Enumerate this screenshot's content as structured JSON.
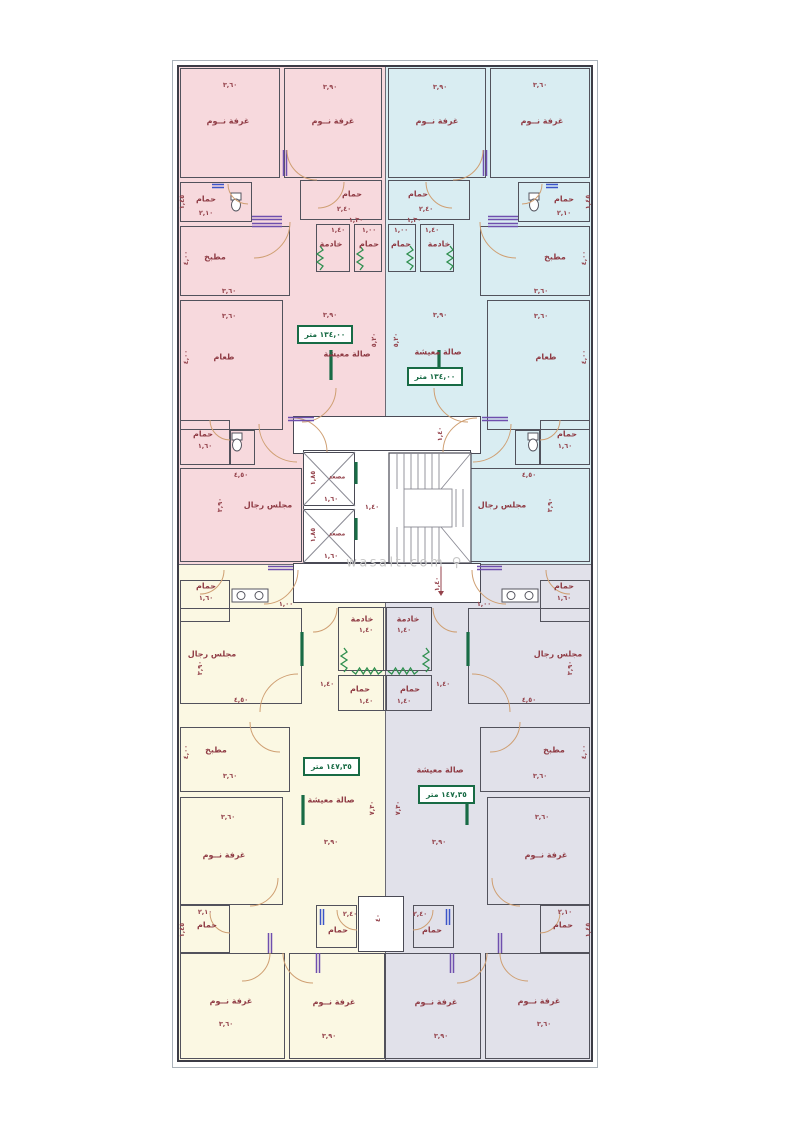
{
  "watermark": {
    "text": "wasalt.com",
    "icon": "⚲"
  },
  "colors": {
    "unit_top_left": "#f7d9dd",
    "unit_top_right": "#d9edf2",
    "unit_bottom_left": "#fbf8e3",
    "unit_bottom_right": "#e1e1ea",
    "wall": "#3c3c46",
    "room_line": "#52525c",
    "label": "#8f3b44",
    "area_green": "#186b45",
    "window_green": "#2f8f4f",
    "door_arc": "#cf9f72",
    "door_leaf_purple": "#6f4fae",
    "door_leaf_blue": "#3b55c9"
  },
  "plan": {
    "axis": 385,
    "frame": {
      "x": 172,
      "y": 60,
      "w": 426,
      "h": 1008
    },
    "outer": {
      "x": 177,
      "y": 65,
      "w": 416,
      "h": 997
    },
    "units": [
      {
        "id": "apartment-top-left",
        "fill": "#f7d9dd",
        "x": 177,
        "y": 65,
        "w": 208,
        "h": 499,
        "area_label": "١٣٤,٠٠ متر"
      },
      {
        "id": "apartment-top-right",
        "fill": "#d9edf2",
        "x": 385,
        "y": 65,
        "w": 208,
        "h": 499,
        "area_label": "١٣٤,٠٠ متر"
      },
      {
        "id": "apartment-bottom-left",
        "fill": "#fbf8e3",
        "x": 177,
        "y": 564,
        "w": 208,
        "h": 498,
        "area_label": "١٤٧,٣٥ متر"
      },
      {
        "id": "apartment-bottom-right",
        "fill": "#e1e1ea",
        "x": 385,
        "y": 564,
        "w": 208,
        "h": 498,
        "area_label": "١٤٧,٣٥ متر"
      }
    ],
    "dividers": [
      {
        "x": 385,
        "y": 65,
        "w": 1,
        "h": 997
      },
      {
        "x": 177,
        "y": 564,
        "w": 416,
        "h": 1
      }
    ],
    "core_white": [
      {
        "x": 293,
        "y": 416,
        "w": 188,
        "h": 38
      },
      {
        "x": 303,
        "y": 450,
        "w": 168,
        "h": 113
      },
      {
        "x": 293,
        "y": 563,
        "w": 188,
        "h": 40
      },
      {
        "x": 358,
        "y": 896,
        "w": 46,
        "h": 56
      },
      {
        "x": 303,
        "y": 452,
        "w": 52,
        "h": 54
      },
      {
        "x": 303,
        "y": 509,
        "w": 52,
        "h": 54
      }
    ],
    "stairs": {
      "x": 389,
      "y": 453,
      "w": 82,
      "h": 110,
      "band": 36,
      "inset": 15
    },
    "top_half": [
      {
        "t": "room",
        "n": "bedroom",
        "x": 180,
        "y": 68,
        "w": 100,
        "h": 110
      },
      {
        "t": "room",
        "n": "bedroom",
        "x": 284,
        "y": 68,
        "w": 98,
        "h": 110
      },
      {
        "t": "room",
        "n": "bathroom",
        "x": 180,
        "y": 182,
        "w": 72,
        "h": 40
      },
      {
        "t": "room",
        "n": "bathroom",
        "x": 300,
        "y": 180,
        "w": 82,
        "h": 40
      },
      {
        "t": "room",
        "n": "maid-room",
        "x": 316,
        "y": 224,
        "w": 34,
        "h": 48
      },
      {
        "t": "room",
        "n": "bathroom",
        "x": 354,
        "y": 224,
        "w": 28,
        "h": 48
      },
      {
        "t": "room",
        "n": "kitchen",
        "x": 180,
        "y": 226,
        "w": 110,
        "h": 70
      },
      {
        "t": "room",
        "n": "dining-room",
        "x": 180,
        "y": 300,
        "w": 103,
        "h": 130
      },
      {
        "t": "room",
        "n": "bathroom",
        "x": 180,
        "y": 420,
        "w": 50,
        "h": 45
      },
      {
        "t": "room",
        "n": "wc-alcove",
        "x": 230,
        "y": 430,
        "w": 25,
        "h": 35
      },
      {
        "t": "room",
        "n": "majlis",
        "x": 180,
        "y": 468,
        "w": 122,
        "h": 94
      },
      {
        "t": "dim",
        "x": 230,
        "y": 85,
        "s": "٣,٦٠"
      },
      {
        "t": "lbl",
        "x": 228,
        "y": 121,
        "s": "غرفة نــوم"
      },
      {
        "t": "dim",
        "x": 330,
        "y": 87,
        "s": "٣,٩٠"
      },
      {
        "t": "lbl",
        "x": 333,
        "y": 121,
        "s": "غرفة نــوم"
      },
      {
        "t": "dim",
        "x": 182,
        "y": 202,
        "s": "١,٤٥",
        "r": 1
      },
      {
        "t": "lbl",
        "x": 206,
        "y": 199,
        "s": "حمام"
      },
      {
        "t": "dim",
        "x": 206,
        "y": 213,
        "s": "٢,١٠"
      },
      {
        "t": "lbl",
        "x": 352,
        "y": 194,
        "s": "حمام"
      },
      {
        "t": "dim",
        "x": 344,
        "y": 209,
        "s": "٢,٤٠"
      },
      {
        "t": "dim",
        "x": 338,
        "y": 230,
        "s": "١,٤٠"
      },
      {
        "t": "lbl",
        "x": 331,
        "y": 244,
        "s": "خادمة"
      },
      {
        "t": "dim",
        "x": 369,
        "y": 230,
        "s": "١,٠٠"
      },
      {
        "t": "lbl",
        "x": 369,
        "y": 244,
        "s": "حمام"
      },
      {
        "t": "lbl",
        "x": 215,
        "y": 257,
        "s": "مطبخ"
      },
      {
        "t": "dim",
        "x": 186,
        "y": 258,
        "s": "٤,٠٠",
        "r": 1
      },
      {
        "t": "dim",
        "x": 229,
        "y": 291,
        "s": "٣,٦٠"
      },
      {
        "t": "dim",
        "x": 229,
        "y": 316,
        "s": "٣,٦٠"
      },
      {
        "t": "lbl",
        "x": 224,
        "y": 357,
        "s": "طعام"
      },
      {
        "t": "dim",
        "x": 186,
        "y": 357,
        "s": "٤,٠٠",
        "r": 1
      },
      {
        "t": "dim",
        "x": 356,
        "y": 220,
        "s": "١,٣٠"
      },
      {
        "t": "dim",
        "x": 330,
        "y": 315,
        "s": "٣,٩٠"
      },
      {
        "t": "dim",
        "x": 374,
        "y": 340,
        "s": "٥,٢٠",
        "r": 1
      },
      {
        "t": "lbl",
        "x": 203,
        "y": 434,
        "s": "حمام"
      },
      {
        "t": "dim",
        "x": 205,
        "y": 446,
        "s": "١,٦٠"
      },
      {
        "t": "dim",
        "x": 241,
        "y": 475,
        "s": "٤,٥٠"
      },
      {
        "t": "lbl",
        "x": 268,
        "y": 505,
        "s": "مجلس رجال"
      },
      {
        "t": "dim",
        "x": 220,
        "y": 505,
        "s": "٣,٩٠",
        "r": 1
      },
      {
        "t": "zz",
        "x": 320,
        "y": 246,
        "l": 24,
        "v": 1
      },
      {
        "t": "zz",
        "x": 360,
        "y": 246,
        "l": 24,
        "v": 1
      },
      {
        "t": "gbar",
        "x": 331,
        "y": 350,
        "l": 30,
        "v": 1
      },
      {
        "t": "wc",
        "x": 236,
        "y": 200
      },
      {
        "t": "wc",
        "x": 237,
        "y": 440
      },
      {
        "t": "door",
        "x": 285,
        "y": 150,
        "l": 26,
        "v": 1,
        "c": "p"
      },
      {
        "t": "door",
        "x": 252,
        "y": 218,
        "l": 30,
        "v": 0,
        "c": "p"
      },
      {
        "t": "door",
        "x": 252,
        "y": 225,
        "l": 30,
        "v": 0,
        "c": "p"
      },
      {
        "t": "door",
        "x": 212,
        "y": 186,
        "l": 12,
        "v": 0,
        "c": "b"
      },
      {
        "t": "arc",
        "x": 317,
        "y": 150,
        "rr": 30,
        "a": 90
      },
      {
        "t": "arc",
        "x": 248,
        "y": 184,
        "rr": 20,
        "a": 90
      },
      {
        "t": "arc",
        "x": 318,
        "y": 182,
        "rr": 26,
        "a": 0
      },
      {
        "t": "arc",
        "x": 254,
        "y": 222,
        "rr": 36,
        "a": 0
      },
      {
        "t": "arc",
        "x": 302,
        "y": 388,
        "rr": 34,
        "a": 0
      },
      {
        "t": "arc",
        "x": 297,
        "y": 424,
        "rr": 38,
        "a": 90
      },
      {
        "t": "arc",
        "x": 230,
        "y": 420,
        "rr": 20,
        "a": 90
      }
    ],
    "bottom_half": [
      {
        "t": "room",
        "n": "bathroom",
        "x": 180,
        "y": 580,
        "w": 50,
        "h": 42
      },
      {
        "t": "room",
        "n": "majlis",
        "x": 180,
        "y": 608,
        "w": 122,
        "h": 96
      },
      {
        "t": "room",
        "n": "maid-room",
        "x": 338,
        "y": 607,
        "w": 49,
        "h": 64
      },
      {
        "t": "room",
        "n": "bathroom",
        "x": 338,
        "y": 675,
        "w": 49,
        "h": 36
      },
      {
        "t": "room",
        "n": "kitchen",
        "x": 180,
        "y": 727,
        "w": 110,
        "h": 65
      },
      {
        "t": "room",
        "n": "bedroom",
        "x": 180,
        "y": 797,
        "w": 103,
        "h": 108
      },
      {
        "t": "room",
        "n": "bathroom",
        "x": 180,
        "y": 905,
        "w": 50,
        "h": 48
      },
      {
        "t": "room",
        "n": "bathroom",
        "x": 316,
        "y": 905,
        "w": 41,
        "h": 43
      },
      {
        "t": "room",
        "n": "bedroom",
        "x": 180,
        "y": 953,
        "w": 105,
        "h": 106
      },
      {
        "t": "room",
        "n": "bedroom",
        "x": 289,
        "y": 953,
        "w": 96,
        "h": 106
      },
      {
        "t": "lbl",
        "x": 206,
        "y": 586,
        "s": "حمام"
      },
      {
        "t": "dim",
        "x": 206,
        "y": 598,
        "s": "١,٦٠"
      },
      {
        "t": "dim",
        "x": 286,
        "y": 604,
        "s": "١,٠٠"
      },
      {
        "t": "lbl",
        "x": 212,
        "y": 654,
        "s": "مجلس رجال"
      },
      {
        "t": "dim",
        "x": 200,
        "y": 668,
        "s": "٣,٩٠",
        "r": 1
      },
      {
        "t": "dim",
        "x": 241,
        "y": 700,
        "s": "٤,٥٠"
      },
      {
        "t": "lbl",
        "x": 362,
        "y": 619,
        "s": "خادمة"
      },
      {
        "t": "dim",
        "x": 366,
        "y": 630,
        "s": "١,٤٠"
      },
      {
        "t": "lbl",
        "x": 360,
        "y": 689,
        "s": "حمام"
      },
      {
        "t": "dim",
        "x": 366,
        "y": 701,
        "s": "١,٤٠"
      },
      {
        "t": "dim",
        "x": 327,
        "y": 684,
        "s": "١,٤٠"
      },
      {
        "t": "lbl",
        "x": 216,
        "y": 750,
        "s": "مطبخ"
      },
      {
        "t": "dim",
        "x": 186,
        "y": 752,
        "s": "٤,٠٠",
        "r": 1
      },
      {
        "t": "dim",
        "x": 230,
        "y": 776,
        "s": "٣,٦٠"
      },
      {
        "t": "dim",
        "x": 228,
        "y": 817,
        "s": "٣,٦٠"
      },
      {
        "t": "lbl",
        "x": 224,
        "y": 855,
        "s": "غرفة نــوم"
      },
      {
        "t": "dim",
        "x": 331,
        "y": 842,
        "s": "٣,٩٠"
      },
      {
        "t": "dim",
        "x": 372,
        "y": 808,
        "s": "٧,٣٠",
        "r": 1
      },
      {
        "t": "dim",
        "x": 205,
        "y": 912,
        "s": "٢,١٠"
      },
      {
        "t": "lbl",
        "x": 207,
        "y": 925,
        "s": "حمام"
      },
      {
        "t": "dim",
        "x": 182,
        "y": 930,
        "s": "١,٤٥",
        "r": 1
      },
      {
        "t": "dim",
        "x": 350,
        "y": 914,
        "s": "٢,٤٠"
      },
      {
        "t": "lbl",
        "x": 338,
        "y": 930,
        "s": "حمام"
      },
      {
        "t": "lbl",
        "x": 231,
        "y": 1001,
        "s": "غرفة نــوم"
      },
      {
        "t": "dim",
        "x": 226,
        "y": 1024,
        "s": "٣,٦٠"
      },
      {
        "t": "lbl",
        "x": 334,
        "y": 1002,
        "s": "غرفة نــوم"
      },
      {
        "t": "dim",
        "x": 329,
        "y": 1036,
        "s": "٣,٩٠"
      },
      {
        "t": "zz",
        "x": 344,
        "y": 648,
        "l": 24,
        "v": 1
      },
      {
        "t": "zz",
        "x": 352,
        "y": 671,
        "l": 30,
        "v": 0
      },
      {
        "t": "gbar",
        "x": 302,
        "y": 632,
        "l": 34,
        "v": 1
      },
      {
        "t": "gbar",
        "x": 303,
        "y": 795,
        "l": 30,
        "v": 1
      },
      {
        "t": "sk2",
        "x": 232,
        "y": 589
      },
      {
        "t": "door",
        "x": 268,
        "y": 568,
        "l": 25,
        "v": 0,
        "c": "p"
      },
      {
        "t": "door",
        "x": 270,
        "y": 933,
        "l": 20,
        "v": 1,
        "c": "p"
      },
      {
        "t": "door",
        "x": 318,
        "y": 953,
        "l": 20,
        "v": 1,
        "c": "p"
      },
      {
        "t": "door",
        "x": 322,
        "y": 909,
        "l": 16,
        "v": 1,
        "c": "b"
      },
      {
        "t": "arc",
        "x": 200,
        "y": 570,
        "rr": 24,
        "a": 0
      },
      {
        "t": "arc",
        "x": 264,
        "y": 570,
        "rr": 34,
        "a": 0
      },
      {
        "t": "arc",
        "x": 313,
        "y": 608,
        "rr": 24,
        "a": 0
      },
      {
        "t": "arc",
        "x": 298,
        "y": 712,
        "rr": 38,
        "a": 180
      },
      {
        "t": "arc",
        "x": 280,
        "y": 722,
        "rr": 30,
        "a": 90
      },
      {
        "t": "arc",
        "x": 250,
        "y": 878,
        "rr": 28,
        "a": 0
      },
      {
        "t": "arc",
        "x": 230,
        "y": 913,
        "rr": 20,
        "a": 90
      },
      {
        "t": "arc",
        "x": 357,
        "y": 910,
        "rr": 20,
        "a": 90
      },
      {
        "t": "arc",
        "x": 313,
        "y": 953,
        "rr": 30,
        "a": 90
      },
      {
        "t": "arc",
        "x": 242,
        "y": 953,
        "rr": 28,
        "a": 0
      }
    ],
    "singles": [
      {
        "t": "xl",
        "x": 303,
        "y": 452,
        "w": 52,
        "h": 54
      },
      {
        "t": "xl",
        "x": 303,
        "y": 509,
        "w": 52,
        "h": 54
      },
      {
        "t": "gbar",
        "x": 356,
        "y": 462,
        "l": 22,
        "v": 1
      },
      {
        "t": "gbar",
        "x": 356,
        "y": 518,
        "l": 22,
        "v": 1
      },
      {
        "t": "arc",
        "x": 293,
        "y": 452,
        "rr": 34,
        "a": 270
      },
      {
        "t": "arc",
        "x": 477,
        "y": 452,
        "rr": 34,
        "a": 180
      },
      {
        "t": "door",
        "x": 288,
        "y": 419,
        "l": 26,
        "v": 0,
        "c": "p"
      },
      {
        "t": "door",
        "x": 482,
        "y": 419,
        "l": 26,
        "v": 0,
        "c": "p"
      },
      {
        "t": "arrow",
        "x": 441,
        "y": 565,
        "l": 26
      },
      {
        "t": "lbl",
        "x": 337,
        "y": 477,
        "s": "مصعد",
        "sz": 1
      },
      {
        "t": "dim",
        "x": 313,
        "y": 478,
        "s": "١,٨٥",
        "r": 1
      },
      {
        "t": "dim",
        "x": 331,
        "y": 499,
        "s": "١,٦٠"
      },
      {
        "t": "lbl",
        "x": 337,
        "y": 534,
        "s": "مصعد",
        "sz": 1
      },
      {
        "t": "dim",
        "x": 313,
        "y": 535,
        "s": "١,٨٥",
        "r": 1
      },
      {
        "t": "dim",
        "x": 331,
        "y": 556,
        "s": "١,٦٠"
      },
      {
        "t": "dim",
        "x": 440,
        "y": 434,
        "s": "١,٤٠",
        "r": 1
      },
      {
        "t": "dim",
        "x": 372,
        "y": 507,
        "s": "١,٤٠"
      },
      {
        "t": "dim",
        "x": 437,
        "y": 584,
        "s": "١,٤٠",
        "r": 1
      },
      {
        "t": "dim",
        "x": 378,
        "y": 918,
        "s": "٤٠",
        "r": 1
      },
      {
        "t": "lbl",
        "x": 347,
        "y": 354,
        "s": "صالة معيشة"
      },
      {
        "t": "abox",
        "x": 297,
        "y": 325,
        "w": 56,
        "h": 19,
        "s": "١٣٤,٠٠ متر"
      },
      {
        "t": "lbl",
        "x": 438,
        "y": 352,
        "s": "صالة معيشة"
      },
      {
        "t": "abox",
        "x": 407,
        "y": 367,
        "w": 56,
        "h": 19,
        "s": "١٣٤,٠٠ متر"
      },
      {
        "t": "lbl",
        "x": 331,
        "y": 800,
        "s": "صالة معيشة"
      },
      {
        "t": "abox",
        "x": 303,
        "y": 757,
        "w": 57,
        "h": 19,
        "s": "١٤٧,٣٥ متر"
      },
      {
        "t": "lbl",
        "x": 440,
        "y": 770,
        "s": "صالة معيشة"
      },
      {
        "t": "abox",
        "x": 418,
        "y": 785,
        "w": 57,
        "h": 19,
        "s": "١٤٧,٣٥ متر"
      }
    ],
    "watermark_pos": {
      "x": 405,
      "y": 563
    }
  }
}
